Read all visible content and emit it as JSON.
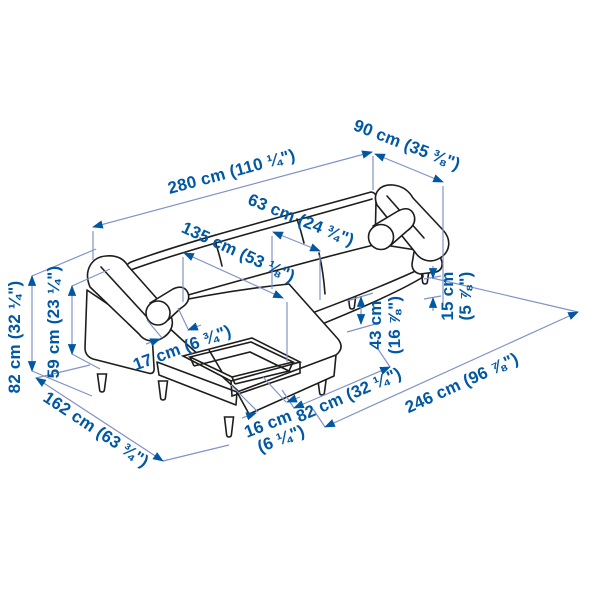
{
  "colors": {
    "label_blue": "#0058a3",
    "dimension_line": "#8294c6",
    "artwork_outline": "#1d1d1b",
    "background": "#ffffff"
  },
  "measurements": {
    "total_width": "280 cm (110 ¼\")",
    "depth": "90 cm (35 ⅜\")",
    "seat_depth": "63 cm (24 ¾\")",
    "chaise_seat_length": "135 cm (53 ⅛\")",
    "armrest_width": "17 cm (6 ¾\")",
    "seat_height": [
      "43 cm",
      "(16 ⅞\")"
    ],
    "leg_height": [
      "15 cm",
      "(5 ⅞\")"
    ],
    "total_height": "82 cm (32 ¼\")",
    "armrest_height": "59 cm (23 ¼\")",
    "chaise_total_depth": "162 cm (63 ¾\")",
    "storage_compartment_width": [
      "16 cm",
      "(6 ¼\")"
    ],
    "chaise_section_width": "82 cm (32 ¼\")",
    "width_without_chaise": "246 cm (96 ⅞\")"
  }
}
